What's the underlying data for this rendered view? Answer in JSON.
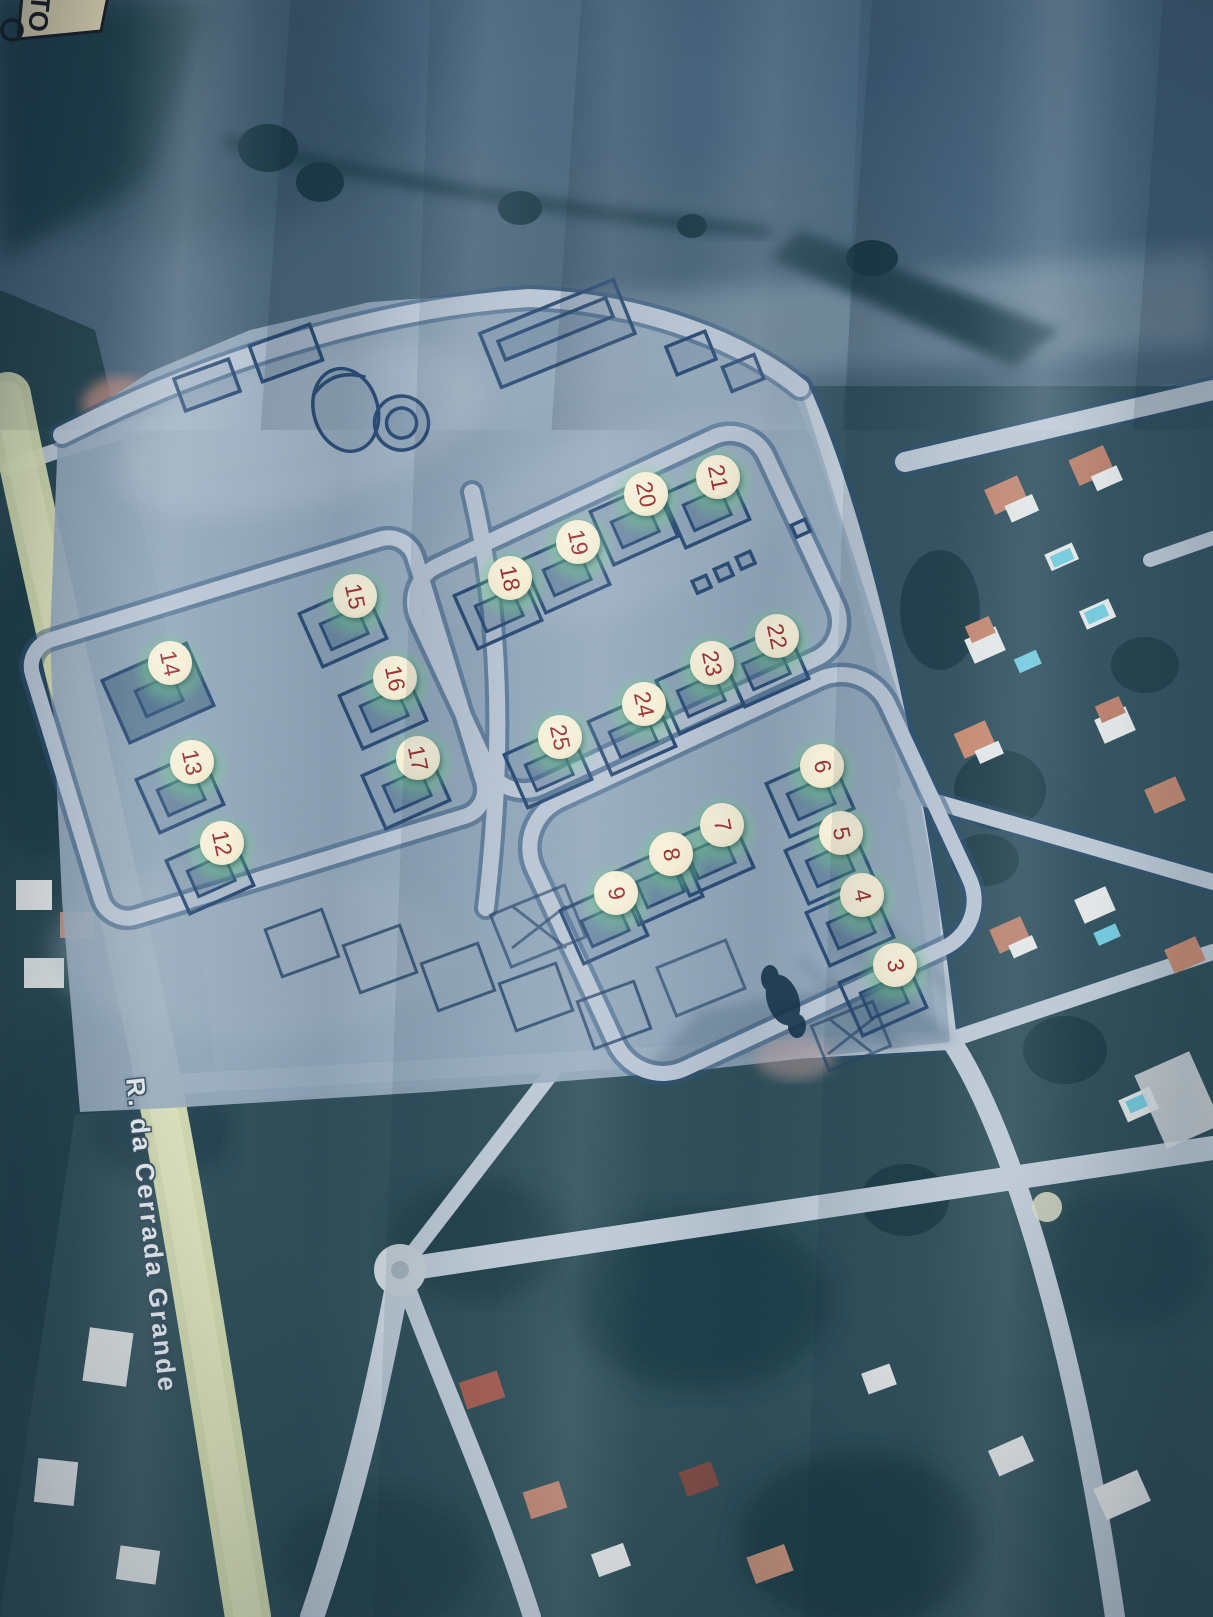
{
  "meta": {
    "description": "Photograph of a printed aerial map with a lot-allotment plan overlay and numbered plots"
  },
  "corner_label": {
    "text": "TO"
  },
  "street_label": {
    "name": "R. da Cerrada Grande"
  },
  "lot_markers": [
    {
      "label": "3",
      "x": 895,
      "y": 965
    },
    {
      "label": "4",
      "x": 862,
      "y": 895
    },
    {
      "label": "5",
      "x": 841,
      "y": 833
    },
    {
      "label": "6",
      "x": 822,
      "y": 766
    },
    {
      "label": "7",
      "x": 722,
      "y": 825
    },
    {
      "label": "8",
      "x": 671,
      "y": 854
    },
    {
      "label": "9",
      "x": 616,
      "y": 893
    },
    {
      "label": "12",
      "x": 222,
      "y": 843
    },
    {
      "label": "13",
      "x": 192,
      "y": 762
    },
    {
      "label": "14",
      "x": 170,
      "y": 663
    },
    {
      "label": "15",
      "x": 355,
      "y": 596
    },
    {
      "label": "16",
      "x": 395,
      "y": 678
    },
    {
      "label": "17",
      "x": 418,
      "y": 758
    },
    {
      "label": "18",
      "x": 510,
      "y": 578
    },
    {
      "label": "19",
      "x": 578,
      "y": 542
    },
    {
      "label": "20",
      "x": 646,
      "y": 494
    },
    {
      "label": "21",
      "x": 718,
      "y": 477
    },
    {
      "label": "22",
      "x": 777,
      "y": 636
    },
    {
      "label": "23",
      "x": 712,
      "y": 663
    },
    {
      "label": "24",
      "x": 644,
      "y": 704
    },
    {
      "label": "25",
      "x": 560,
      "y": 737
    }
  ],
  "colors": {
    "marker_fill": "#f5eed6",
    "marker_text": "#9c3434",
    "plan_fill": "#95a9bc",
    "plan_ink": "#2b4b72",
    "road_light": "#bac6d3",
    "street_band": "#d9dfb0",
    "field_dark": "#24434f",
    "suburb_base": "#33515e",
    "roof_salmon": "#c08570",
    "pool_blue": "#72c9dd",
    "house_white": "#e2e6e6",
    "label_cream": "#eee1ba",
    "ink_dark": "#1b1d24"
  }
}
